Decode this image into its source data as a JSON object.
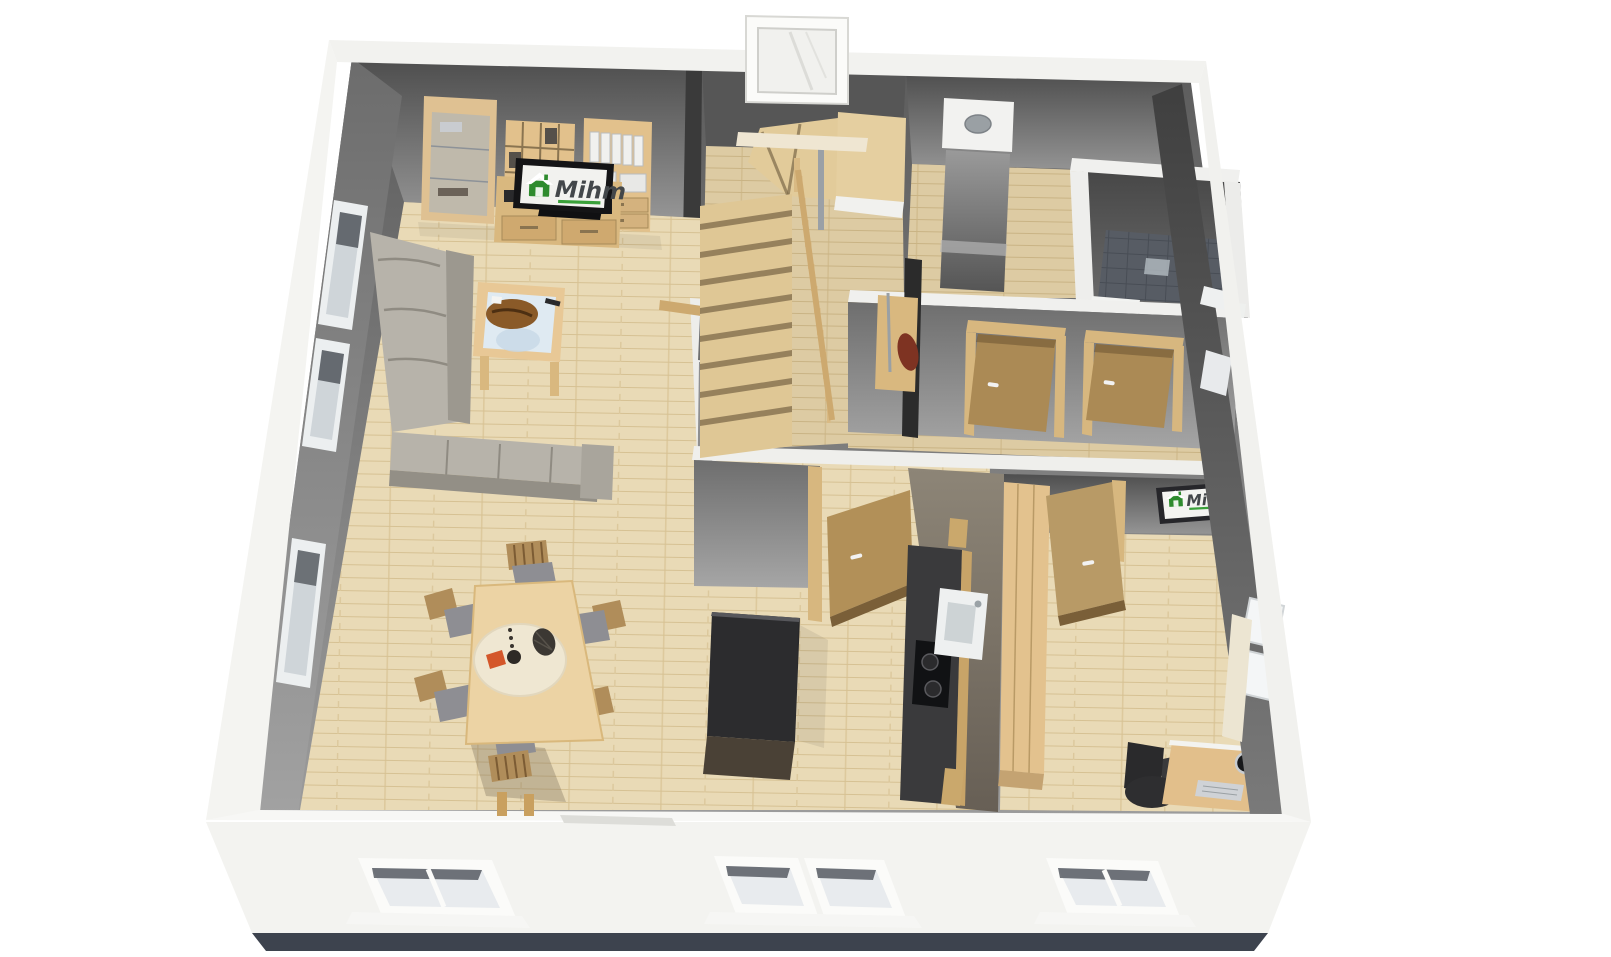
{
  "scene": {
    "type": "3d-floorplan-render",
    "view": "isometric top-down dollhouse view",
    "floor": "ground floor of a residential house"
  },
  "branding": {
    "logo_text": "Mihm",
    "logo_text_color": "#43474a",
    "logo_green": "#2e8b2e",
    "appears_on": [
      "living-room-tv-screen",
      "office-wall-sign"
    ]
  },
  "colors": {
    "outer_wall_white": "#f4f4f1",
    "foundation_dark": "#3d434e",
    "interior_wall_gray": "#8a8a8a",
    "floor_wood_light": "#e9dab6",
    "floor_wood_hall": "#ddcba3",
    "furniture_wood": "#e2c18c",
    "door_wood": "#b29058",
    "sofa_gray": "#b7b3aa",
    "island_black": "#2c2c2e",
    "counter_black": "#3a3a3c",
    "shower_tile_dark": "#575c64",
    "glass_blue": "#dfeaf2",
    "accent_orange": "#d4572a",
    "bag_red": "#7e3322"
  },
  "rooms": [
    {
      "name": "living-room",
      "furniture": [
        "glass-display-cabinet",
        "open-bookshelf",
        "tv-lowboard",
        "flatscreen-tv-with-mihm-logo",
        "binder-shelf",
        "corner-sofa",
        "glass-coffee-table"
      ],
      "windows": 3
    },
    {
      "name": "dining-area",
      "furniture": [
        "dining-table",
        "six-chairs",
        "round-cream-mat",
        "centerpiece-napkin-vase-basket"
      ]
    },
    {
      "name": "stair-hall",
      "furniture": [
        "winding-staircase",
        "wood-railing",
        "stair-window",
        "coat-rack-with-bag-and-bench"
      ]
    },
    {
      "name": "corridor",
      "furniture": [
        "open-door-1",
        "open-door-2"
      ]
    },
    {
      "name": "utility-room",
      "furniture": [
        "chimney-block"
      ]
    },
    {
      "name": "bathroom",
      "furniture": [
        "tiled-shower-floor",
        "white-partition-frame"
      ]
    },
    {
      "name": "kitchen",
      "furniture": [
        "black-island-block",
        "dark-counter-run",
        "cooktop",
        "white-sink",
        "open-wood-door"
      ]
    },
    {
      "name": "office",
      "furniture": [
        "wood-wardrobe",
        "mihm-wall-sign",
        "desk",
        "office-chair",
        "keyboard",
        "desk-lamp",
        "open-wood-door",
        "window-with-radiator"
      ]
    }
  ],
  "counts": {
    "mihm_logos": 2,
    "open_doors": 4,
    "facade_windows_front": 4,
    "stairs_visible": true
  }
}
